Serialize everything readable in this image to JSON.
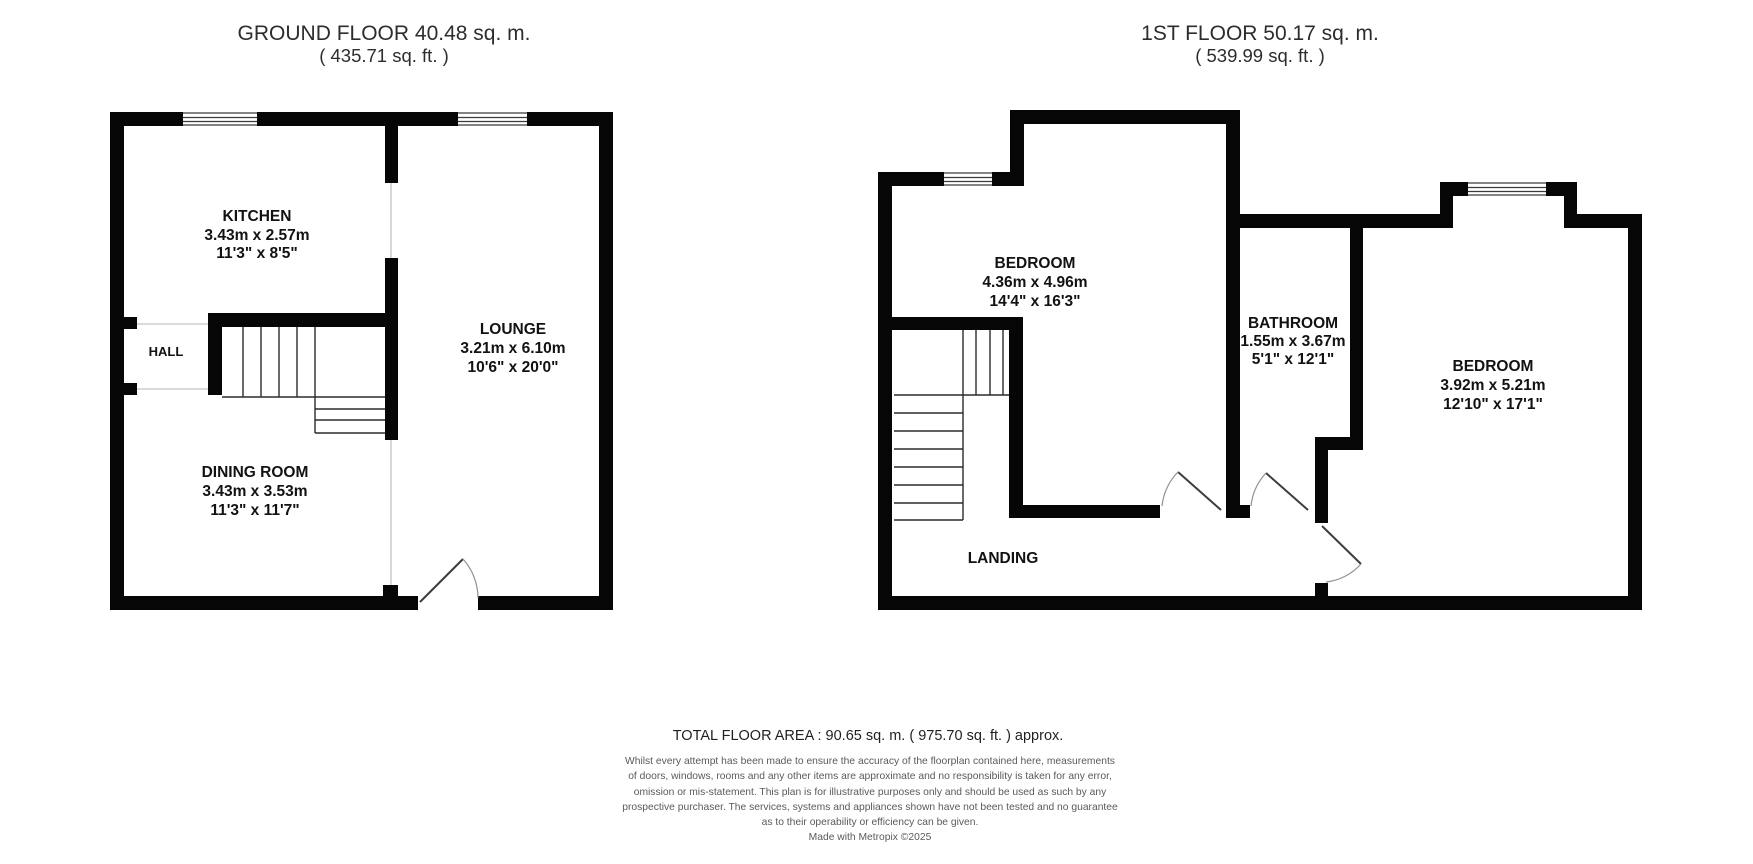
{
  "ground_floor": {
    "title": "GROUND FLOOR 40.48 sq. m.",
    "subtitle": "( 435.71 sq. ft. )",
    "rooms": {
      "kitchen": {
        "name": "KITCHEN",
        "dims_m": "3.43m x 2.57m",
        "dims_ft": "11'3\" x 8'5\""
      },
      "lounge": {
        "name": "LOUNGE",
        "dims_m": "3.21m x 6.10m",
        "dims_ft": "10'6\" x 20'0\""
      },
      "dining_room": {
        "name": "DINING ROOM",
        "dims_m": "3.43m x 3.53m",
        "dims_ft": "11'3\" x 11'7\""
      },
      "hall": {
        "name": "HALL"
      }
    }
  },
  "first_floor": {
    "title": "1ST FLOOR 50.17 sq. m.",
    "subtitle": "( 539.99 sq. ft. )",
    "rooms": {
      "bedroom1": {
        "name": "BEDROOM",
        "dims_m": "4.36m x 4.96m",
        "dims_ft": "14'4\" x 16'3\""
      },
      "bathroom": {
        "name": "BATHROOM",
        "dims_m": "1.55m x 3.67m",
        "dims_ft": "5'1\" x 12'1\""
      },
      "bedroom2": {
        "name": "BEDROOM",
        "dims_m": "3.92m x 5.21m",
        "dims_ft": "12'10\" x 17'1\""
      },
      "landing": {
        "name": "LANDING"
      }
    }
  },
  "footer": {
    "total_area": "TOTAL FLOOR AREA : 90.65 sq. m. ( 975.70 sq. ft. ) approx.",
    "disclaimer_lines": [
      "Whilst every attempt has been made to ensure the accuracy of the floorplan contained here, measurements",
      "of doors, windows, rooms and any other items are approximate and no responsibility is taken for any error,",
      "omission or mis-statement. This plan is for illustrative purposes only and should be used as such by any",
      "prospective purchaser. The services, systems and appliances shown have not been tested and no guarantee",
      "as to their operability or efficiency can be given."
    ],
    "credit": "Made with Metropix ©2025"
  },
  "colors": {
    "wall": "#060606",
    "text": "#121212",
    "muted": "#5a5a5a"
  }
}
